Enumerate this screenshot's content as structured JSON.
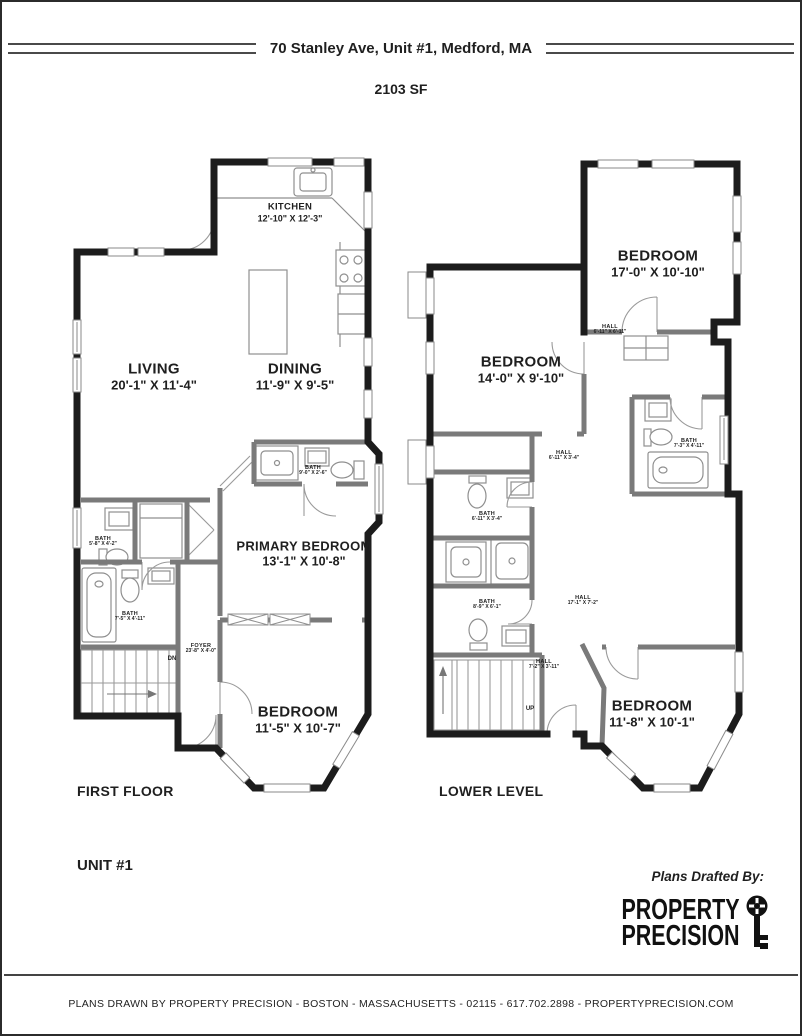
{
  "header": {
    "title": "70 Stanley Ave, Unit #1, Medford, MA",
    "area": "2103 SF"
  },
  "first_floor": {
    "caption": "FIRST FLOOR",
    "stairs_label": "DN",
    "rooms": {
      "kitchen": {
        "name": "KITCHEN",
        "dims": "12'-10\" X 12'-3\""
      },
      "living": {
        "name": "LIVING",
        "dims": "20'-1\" X 11'-4\""
      },
      "dining": {
        "name": "DINING",
        "dims": "11'-9\" X 9'-5\""
      },
      "primary_bedroom": {
        "name": "PRIMARY BEDROOM",
        "dims": "13'-1\" X 10'-8\""
      },
      "bedroom": {
        "name": "BEDROOM",
        "dims": "11'-5\" X 10'-7\""
      },
      "bath_hall": {
        "name": "BATH",
        "dims": "9'-0\" X 2'-6\""
      },
      "bath_upper": {
        "name": "BATH",
        "dims": "5'-8\" X 4'-2\""
      },
      "bath_lower": {
        "name": "BATH",
        "dims": "7'-5\" X 4'-11\""
      },
      "foyer": {
        "name": "FOYER",
        "dims": "23'-8\" X 4'-0\""
      }
    }
  },
  "lower_level": {
    "caption": "LOWER LEVEL",
    "stairs_label": "UP",
    "rooms": {
      "bedroom_rear": {
        "name": "BEDROOM",
        "dims": "17'-0\" X 10'-10\""
      },
      "bedroom_middle": {
        "name": "BEDROOM",
        "dims": "14'-0\" X 9'-10\""
      },
      "bedroom_front": {
        "name": "BEDROOM",
        "dims": "11'-8\" X 10'-1\""
      },
      "hall_rear": {
        "name": "HALL",
        "dims": "6'-11\" X 6'-11\""
      },
      "hall_middle": {
        "name": "HALL",
        "dims": "6'-11\" X 3'-4\""
      },
      "hall_main": {
        "name": "HALL",
        "dims": "17'-1\" X 7'-2\""
      },
      "hall_front": {
        "name": "HALL",
        "dims": "7'-2\" X 3'-11\""
      },
      "bath_ensuite": {
        "name": "BATH",
        "dims": "7'-3\" X 4'-11\""
      },
      "bath_upper": {
        "name": "BATH",
        "dims": "6'-11\" X 3'-4\""
      },
      "bath_lower": {
        "name": "BATH",
        "dims": "8'-9\" X 6'-1\""
      }
    }
  },
  "footer_block": {
    "unit": "UNIT #1",
    "drafted_by": "Plans Drafted By:",
    "brand_line1": "PROPERTY",
    "brand_line2": "PRECISION",
    "footer_text": "PLANS DRAWN BY PROPERTY PRECISION - BOSTON - MASSACHUSETTS - 02115 - 617.702.2898 - PROPERTYPRECISION.COM"
  },
  "colors": {
    "exterior_wall": "#1c1c1c",
    "interior_wall": "#7a7a7a",
    "fixture": "#8f8f8f",
    "text": "#1f1f1f"
  }
}
